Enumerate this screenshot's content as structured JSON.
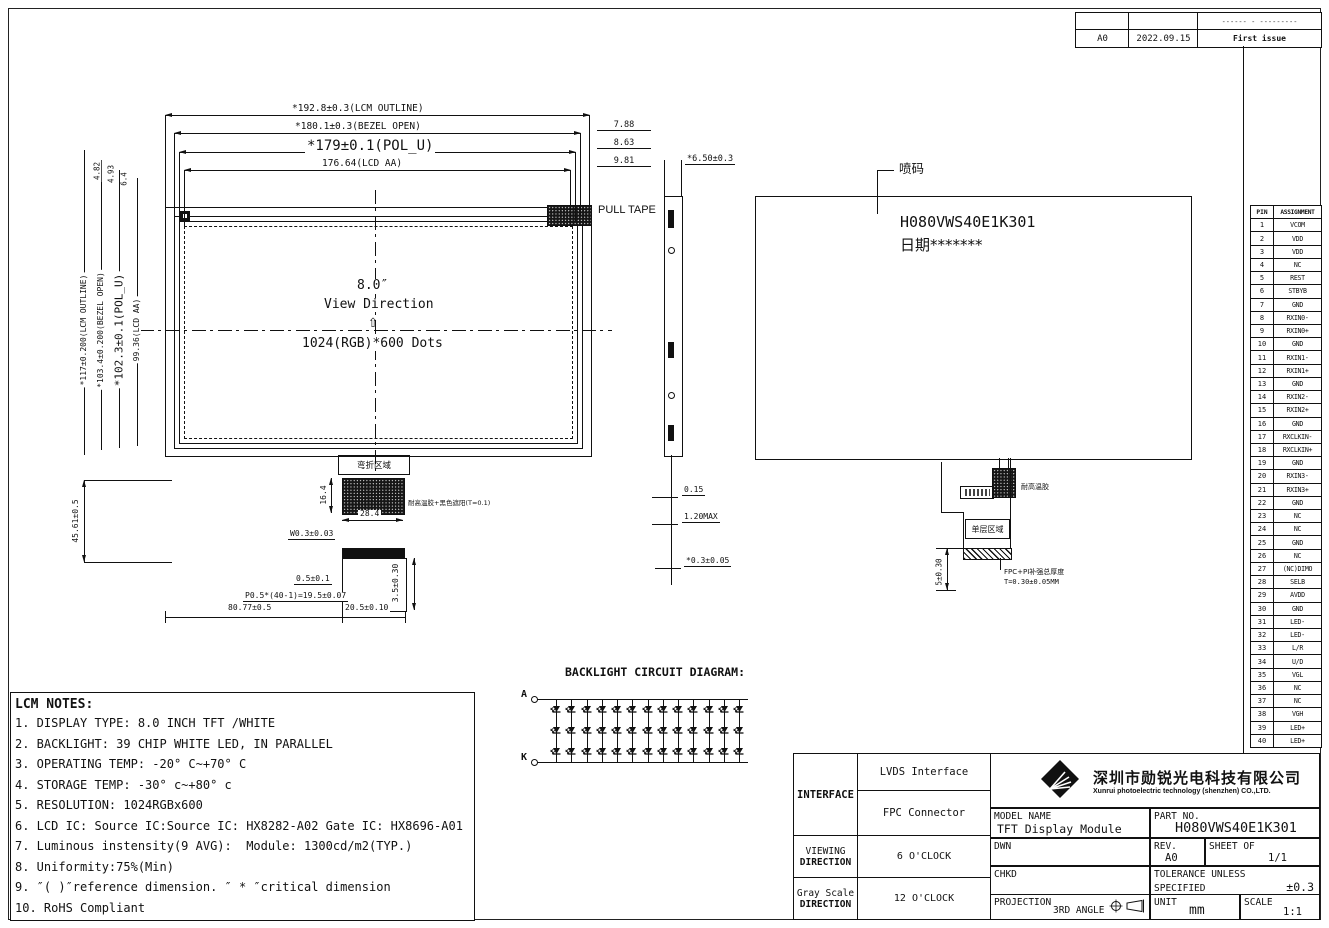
{
  "revision": {
    "header_note": "------ - ---------",
    "rev": "A0",
    "date": "2022.09.15",
    "description": "First issue"
  },
  "front_view": {
    "dim_lcm_outline_h": "*192.8±0.3(LCM OUTLINE)",
    "dim_bezel_h": "*180.1±0.3(BEZEL OPEN)",
    "dim_pol_h": "*179±0.1(POL_U)",
    "dim_aa_h": "176.64(LCD AA)",
    "dim_right_1": "7.88",
    "dim_right_2": "8.63",
    "dim_right_3": "9.81",
    "dim_lcm_outline_v": "*117±0.200(LCM OUTLINE)",
    "dim_bezel_v": "*103.4±0.200(BEZEL OPEN)",
    "dim_pol_v": "*102.3±0.1(POL_U)",
    "dim_aa_v": "99.36(LCD AA)",
    "dim_top_left_1": "4.82",
    "dim_top_left_2": "4.93",
    "dim_top_left_3": "6.4",
    "dim_left_bottom": "45.61±0.5",
    "size": "8.0″",
    "view_direction": "View Direction",
    "view_arrow": "⇧",
    "resolution": "1024(RGB)*600 Dots",
    "pull_tape": "PULL TAPE"
  },
  "fpc_front": {
    "bend_area": "弯折区域",
    "dim_h": "16.4",
    "dim_w": "28.4",
    "tape_note": "耐高温胶+黑色遮阳(T=0.1)",
    "dim_w03": "W0.3±0.03",
    "dim_05": "0.5±0.1",
    "dim_pitch": "P0.5*(40-1)=19.5±0.07",
    "dim_8077": "80.77±0.5",
    "dim_205": "20.5±0.10",
    "dim_35": "3.5±0.30"
  },
  "side_view": {
    "dim_thick": "*6.50±0.3",
    "dim_015": "0.15",
    "dim_120": "1.20MAX",
    "dim_03": "*0.3±0.05"
  },
  "back_view": {
    "callout": "喷码",
    "marking_line1": "H080VWS40E1K301",
    "marking_line2": "日期*******",
    "tape_note": "耐高温胶",
    "single_layer": "单层区域",
    "stiffener_note_1": "FPC+PI补强总厚度",
    "stiffener_note_2": "T=0.30±0.05MM",
    "dim_5": "5±0.30"
  },
  "pin_table": {
    "headers": [
      "PIN",
      "ASSIGNMENT"
    ],
    "pins": [
      [
        "1",
        "VCOM"
      ],
      [
        "2",
        "VDD"
      ],
      [
        "3",
        "VDD"
      ],
      [
        "4",
        "NC"
      ],
      [
        "5",
        "REST"
      ],
      [
        "6",
        "STBYB"
      ],
      [
        "7",
        "GND"
      ],
      [
        "8",
        "RXIN0-"
      ],
      [
        "9",
        "RXIN0+"
      ],
      [
        "10",
        "GND"
      ],
      [
        "11",
        "RXIN1-"
      ],
      [
        "12",
        "RXIN1+"
      ],
      [
        "13",
        "GND"
      ],
      [
        "14",
        "RXIN2-"
      ],
      [
        "15",
        "RXIN2+"
      ],
      [
        "16",
        "GND"
      ],
      [
        "17",
        "RXCLKIN-"
      ],
      [
        "18",
        "RXCLKIN+"
      ],
      [
        "19",
        "GND"
      ],
      [
        "20",
        "RXIN3-"
      ],
      [
        "21",
        "RXIN3+"
      ],
      [
        "22",
        "GND"
      ],
      [
        "23",
        "NC"
      ],
      [
        "24",
        "NC"
      ],
      [
        "25",
        "GND"
      ],
      [
        "26",
        "NC"
      ],
      [
        "27",
        "(NC)DIMO"
      ],
      [
        "28",
        "SELB"
      ],
      [
        "29",
        "AVDD"
      ],
      [
        "30",
        "GND"
      ],
      [
        "31",
        "LED-"
      ],
      [
        "32",
        "LED-"
      ],
      [
        "33",
        "L/R"
      ],
      [
        "34",
        "U/D"
      ],
      [
        "35",
        "VGL"
      ],
      [
        "36",
        "NC"
      ],
      [
        "37",
        "NC"
      ],
      [
        "38",
        "VGH"
      ],
      [
        "39",
        "LED+"
      ],
      [
        "40",
        "LED+"
      ]
    ]
  },
  "backlight": {
    "title": "BACKLIGHT CIRCUIT DIAGRAM:",
    "anode": "A",
    "cathode": "K",
    "columns": 13,
    "rows": 3
  },
  "notes": {
    "title": "LCM NOTES:",
    "items": [
      "1. DISPLAY TYPE: 8.0 INCH TFT /WHITE",
      "2. BACKLIGHT: 39 CHIP WHITE LED, IN PARALLEL",
      "3. OPERATING TEMP: -20° C~+70° C",
      "4. STORAGE TEMP: -30° c~+80° c",
      "5. RESOLUTION: 1024RGBx600",
      "6. LCD IC: Source IC:Source IC: HX8282-A02 Gate IC: HX8696-A01",
      "7. Luminous instensity(9 AVG):  Module: 1300cd/m2(TYP.)",
      "8. Uniformity:75%(Min)",
      "9. ″( )″reference dimension. ″ * ″critical dimension",
      "10. RoHS Compliant"
    ]
  },
  "title_block": {
    "interface_label": "INTERFACE",
    "interface_1": "LVDS Interface",
    "interface_2": "FPC Connector",
    "viewing_label_1": "VIEWING",
    "viewing_label_2": "DIRECTION",
    "viewing_value": "6 O'CLOCK",
    "gray_label_1": "Gray Scale",
    "gray_label_2": "DIRECTION",
    "gray_value": "12 O'CLOCK",
    "company_cn": "深圳市勋锐光电科技有限公司",
    "company_en": "Xunrui photoelectric technology (shenzhen) CO.,LTD.",
    "model_name_label": "MODEL NAME",
    "model_name": "TFT Display Module",
    "part_no_label": "PART NO.",
    "part_no": "H080VWS40E1K301",
    "dwn_label": "DWN",
    "chkd_label": "CHKD",
    "rev_label": "REV.",
    "rev": "A0",
    "sheet_label": "SHEET OF",
    "sheet": "1/1",
    "tolerance_label_1": "TOLERANCE UNLESS",
    "tolerance_label_2": "SPECIFIED",
    "tolerance": "±0.3",
    "projection_label": "PROJECTION",
    "projection": "3RD ANGLE",
    "unit_label": "UNIT",
    "unit": "mm",
    "scale_label": "SCALE",
    "scale": "1:1"
  }
}
